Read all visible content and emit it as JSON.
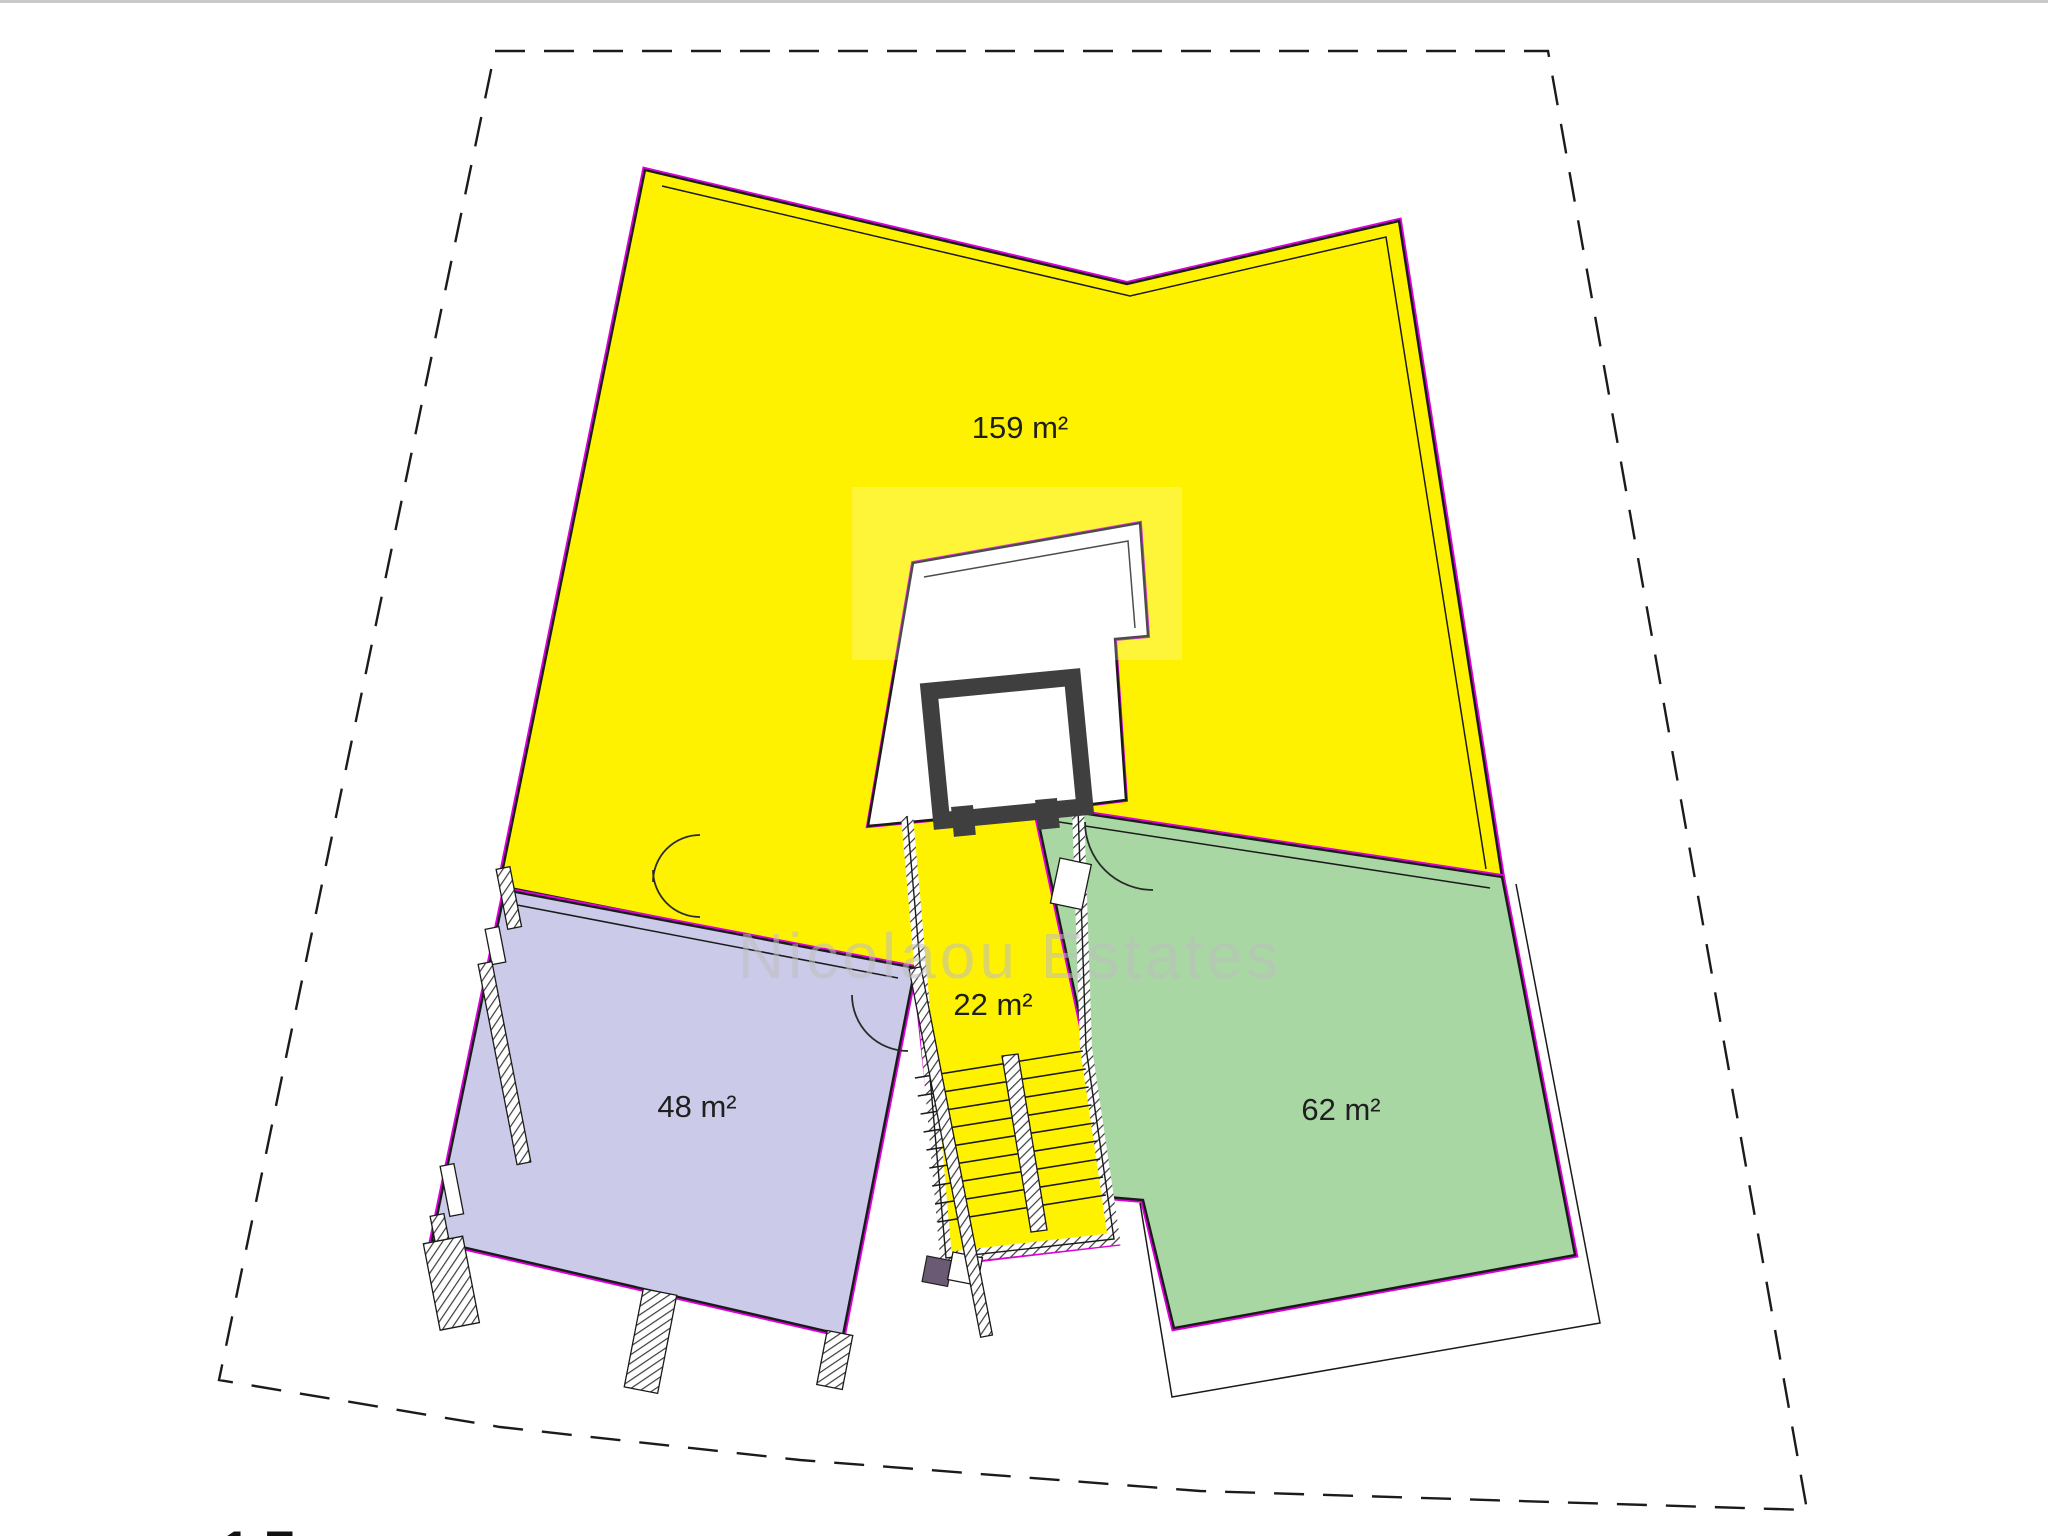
{
  "plan": {
    "areas": [
      {
        "id": "unit-main",
        "label": "159 m²"
      },
      {
        "id": "stairwell",
        "label": "22 m²"
      },
      {
        "id": "unit-left",
        "label": "48 m²"
      },
      {
        "id": "unit-right",
        "label": "62 m²"
      }
    ],
    "watermark": "Nicolaou Estates",
    "bottom_clipped_text": "1 F"
  },
  "colors": {
    "yellow": "#FFF200",
    "green": "#A8D7A3",
    "purple": "#CBCAE8",
    "magenta": "#DD00DD"
  }
}
